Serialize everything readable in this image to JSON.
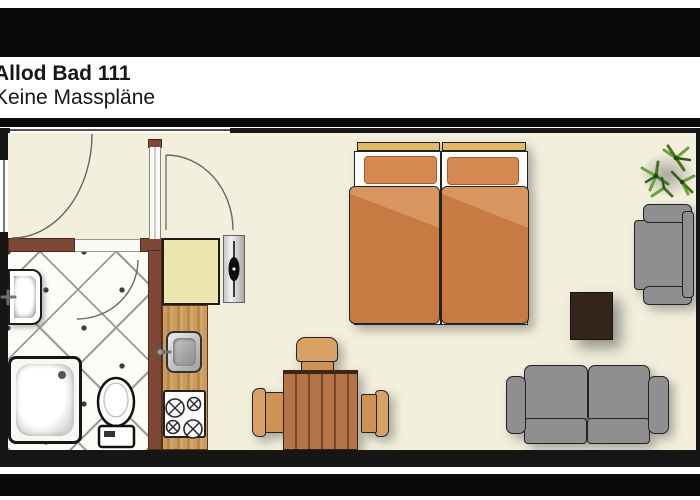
{
  "header": {
    "title": "Allod Bad 111",
    "subtitle": "Keine Masspläne"
  },
  "palette": {
    "bar_black": "#0a0a0a",
    "floor": "#f2efdc",
    "wall_black": "#161616",
    "wall_brown": "#7d4936",
    "cabinet": "#ece7ae",
    "headboard": "#e3b766",
    "pillow": "#d5884f",
    "bed_orange": "#c87a43",
    "bed_fold": "#d9955f",
    "chair": "#d9a164",
    "sofa_gray": "#8f8f8f",
    "coffee_table": "#33241c",
    "plant_green_1": "#6da13d",
    "plant_green_2": "#497522",
    "plant_green_3": "#2f5a14"
  },
  "floorplan": {
    "description": "studio apartment floor plan, top view",
    "rooms": [
      "entry hall",
      "bathroom",
      "kitchen",
      "bedroom / living room"
    ],
    "furniture": [
      "entry door",
      "second door",
      "window",
      "washbasin",
      "shower tray",
      "toilet",
      "kitchen cabinet",
      "kitchen sink",
      "stove",
      "radiator",
      "twin beds",
      "dining table",
      "three chairs",
      "sofa",
      "armchair",
      "coffee table",
      "potted plant"
    ]
  }
}
